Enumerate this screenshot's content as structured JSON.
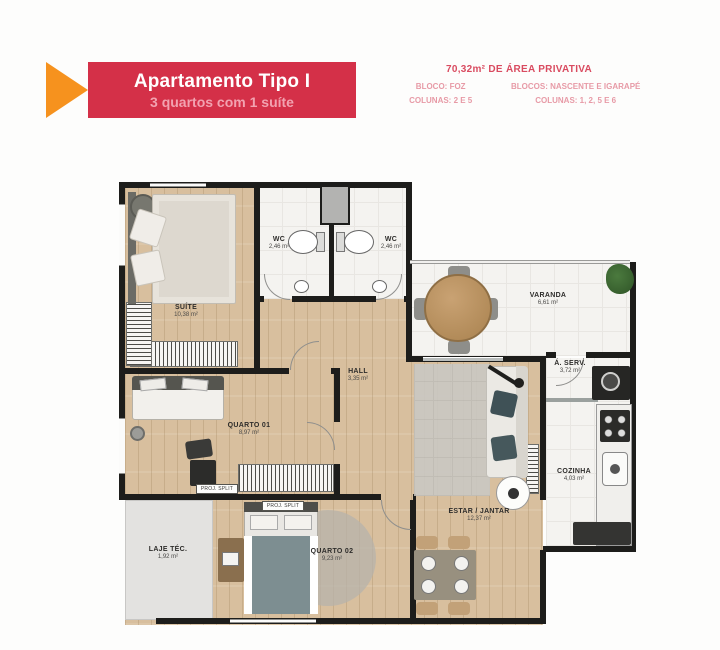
{
  "header": {
    "title": "Apartamento Tipo I",
    "subtitle": "3 quartos com 1 suíte",
    "area_heading": "70,32m² DE ÁREA PRIVATIVA",
    "left_block": {
      "line1": "BLOCO: FOZ",
      "line2": "COLUNAS: 2 E 5"
    },
    "right_block": {
      "line1": "BLOCOS: NASCENTE E IGARAPÉ",
      "line2": "COLUNAS: 1, 2, 5 E 6"
    }
  },
  "colors": {
    "banner_red": "#d43048",
    "arrow_orange": "#f6921e",
    "subtitle_pink": "#f2a2b0",
    "heading_red": "#d94b60",
    "info_pink": "#e79aa6",
    "wall_black": "#1d1d1b",
    "wood_tan": "#d8bf9e"
  },
  "rooms": [
    {
      "name": "SUÍTE",
      "area": "10,38 m²"
    },
    {
      "name": "WC",
      "area": "2,46 m²"
    },
    {
      "name": "WC",
      "area": "2,46 m²"
    },
    {
      "name": "VARANDA",
      "area": "6,61 m²"
    },
    {
      "name": "Á. SERV.",
      "area": "3,72 m²"
    },
    {
      "name": "HALL",
      "area": "3,35 m²"
    },
    {
      "name": "QUARTO 01",
      "area": "8,97 m²"
    },
    {
      "name": "ESTAR / JANTAR",
      "area": "12,37 m²"
    },
    {
      "name": "COZINHA",
      "area": "4,03 m²"
    },
    {
      "name": "QUARTO 02",
      "area": "9,23 m²"
    },
    {
      "name": "LAJE TÉC.",
      "area": "1,92 m²"
    }
  ],
  "annotations": {
    "proj_split": "PROJ. SPLIT"
  }
}
